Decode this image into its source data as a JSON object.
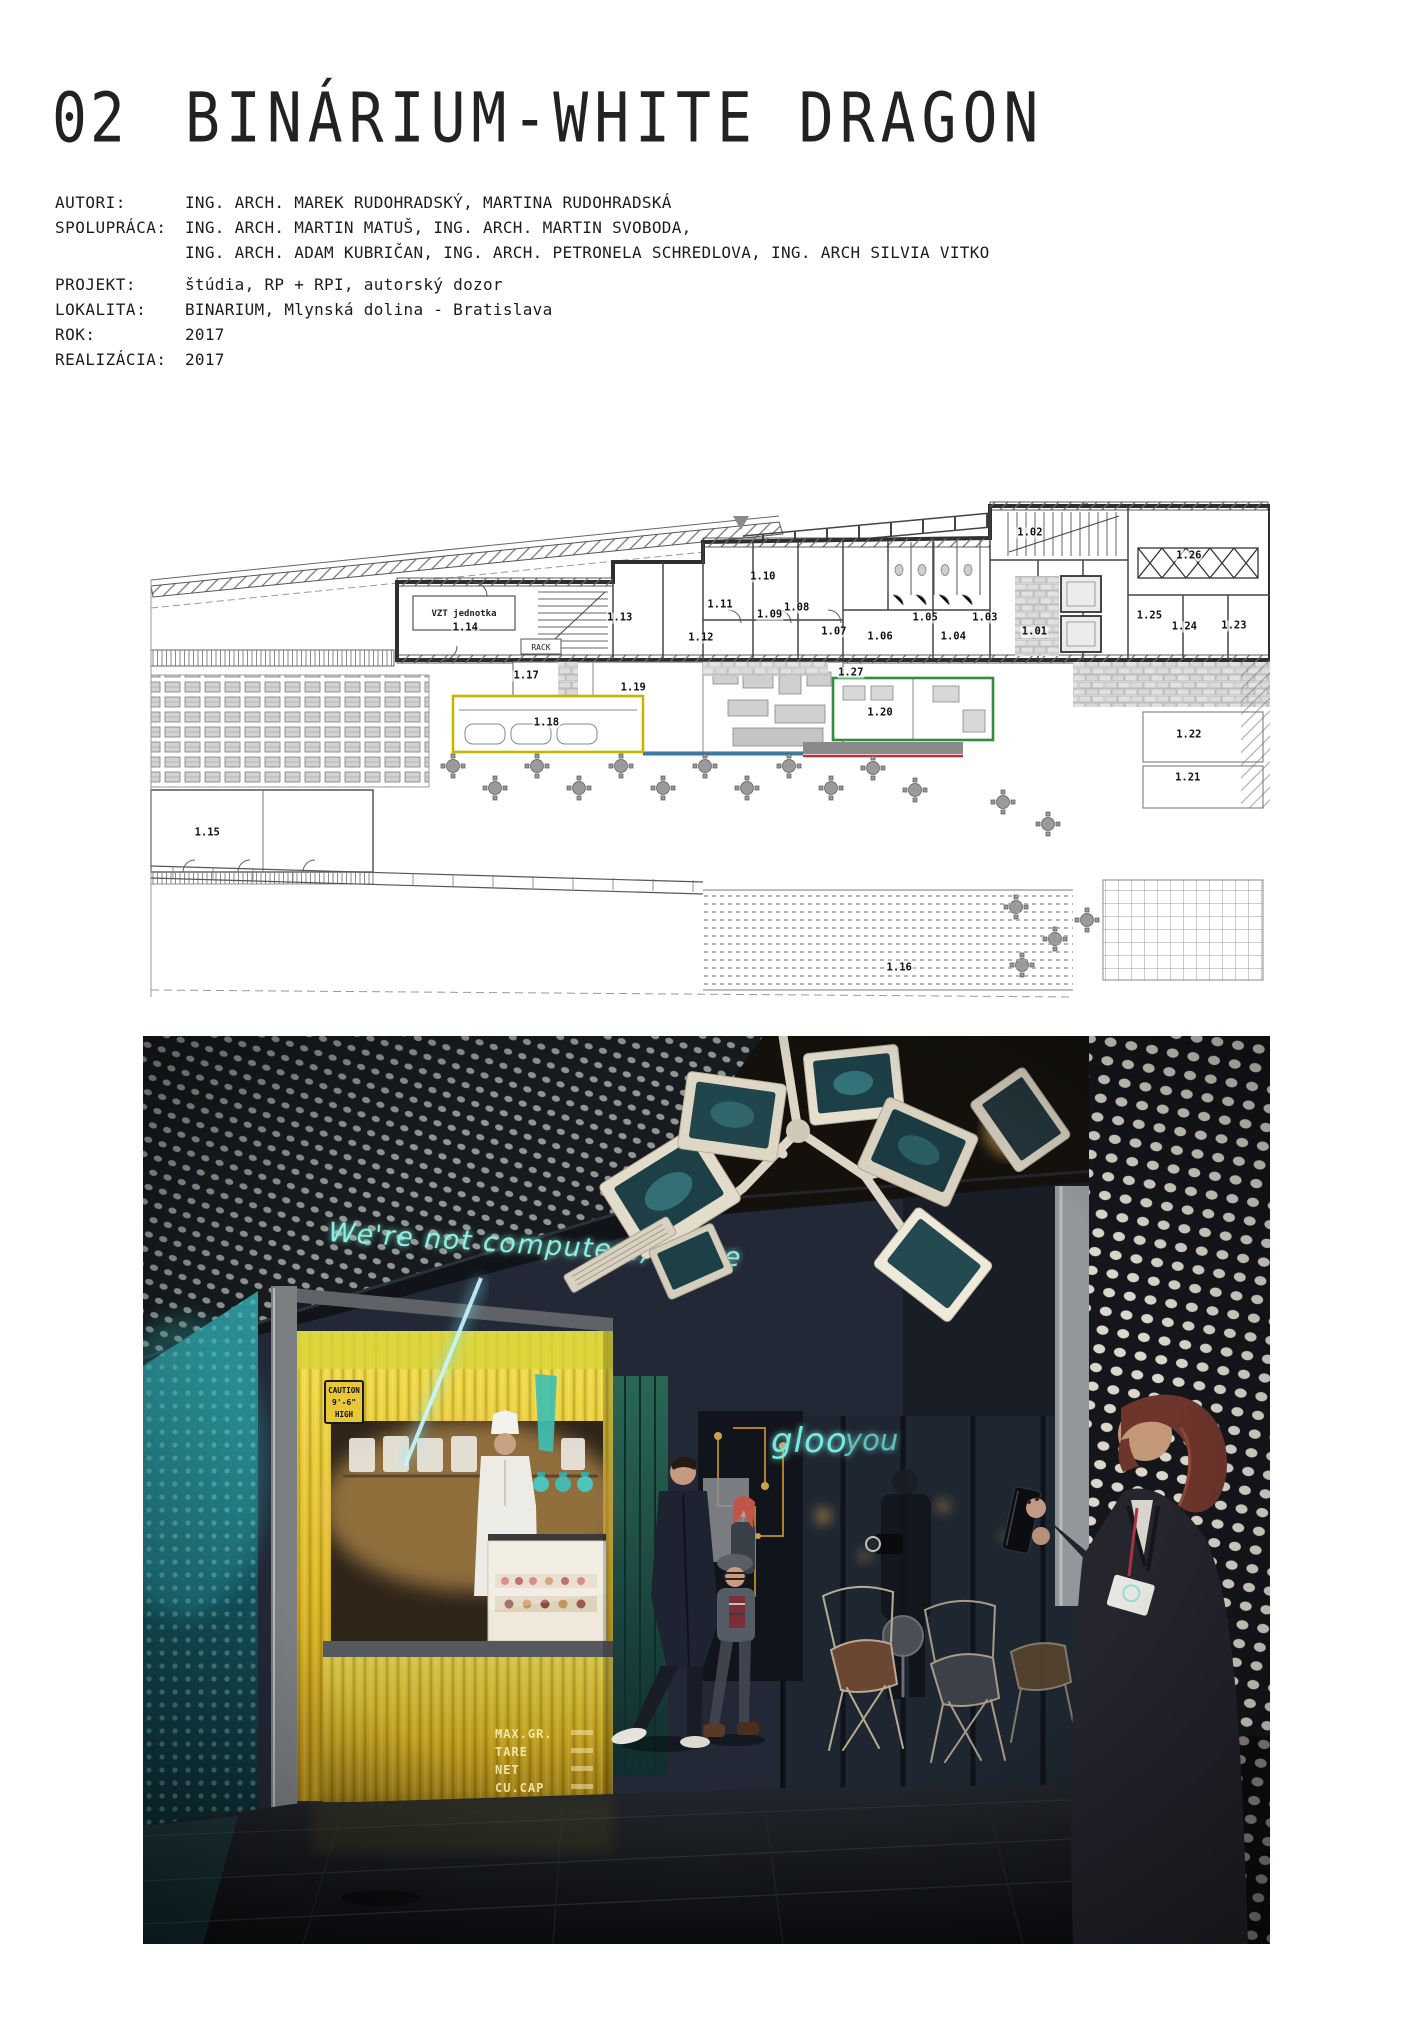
{
  "page": {
    "number": "02",
    "title": "BINÁRIUM-WHITE DRAGON"
  },
  "metadata": {
    "rows": [
      {
        "label": "AUTORI:",
        "value": "ING. ARCH. MAREK RUDOHRADSKÝ, MARTINA RUDOHRADSKÁ"
      },
      {
        "label": "SPOLUPRÁCA:",
        "value": "ING. ARCH. MARTIN MATUŠ, ING. ARCH. MARTIN SVOBODA,"
      },
      {
        "label": "",
        "value": "ING. ARCH. ADAM KUBRIČAN, ING. ARCH. PETRONELA SCHREDLOVA, ING. ARCH SILVIA VITKO"
      },
      {
        "label": "PROJEKT:",
        "value": "štúdia, RP + RPI, autorský dozor"
      },
      {
        "label": "LOKALITA:",
        "value": "BINARIUM, Mlynská dolina - Bratislava"
      },
      {
        "label": "ROK:",
        "value": "2017"
      },
      {
        "label": "REALIZÁCIA:",
        "value": "2017"
      }
    ]
  },
  "floor_plan": {
    "annotations": {
      "vzt_unit": "VZT jednotka",
      "rack": "RACK"
    },
    "accent_colors": {
      "yellow": "#c9b500",
      "green": "#2f8f3a",
      "red": "#c03030",
      "blue": "#2b7bb5"
    },
    "rooms": [
      {
        "label": "1.01",
        "x": 79.1,
        "y": 26.4
      },
      {
        "label": "1.02",
        "x": 78.7,
        "y": 6.6
      },
      {
        "label": "1.03",
        "x": 74.7,
        "y": 23.6
      },
      {
        "label": "1.04",
        "x": 71.9,
        "y": 27.4
      },
      {
        "label": "1.05",
        "x": 69.4,
        "y": 23.6
      },
      {
        "label": "1.06",
        "x": 65.4,
        "y": 27.4
      },
      {
        "label": "1.07",
        "x": 61.3,
        "y": 26.4
      },
      {
        "label": "1.08",
        "x": 58.0,
        "y": 21.6
      },
      {
        "label": "1.09",
        "x": 55.6,
        "y": 23.0
      },
      {
        "label": "1.10",
        "x": 55.0,
        "y": 15.4
      },
      {
        "label": "1.11",
        "x": 51.2,
        "y": 21.0
      },
      {
        "label": "1.12",
        "x": 49.5,
        "y": 27.6
      },
      {
        "label": "1.13",
        "x": 42.3,
        "y": 23.6
      },
      {
        "label": "1.14",
        "x": 28.6,
        "y": 25.6
      },
      {
        "label": "1.15",
        "x": 5.7,
        "y": 66.6
      },
      {
        "label": "1.16",
        "x": 67.1,
        "y": 93.6
      },
      {
        "label": "1.17",
        "x": 34.0,
        "y": 35.2
      },
      {
        "label": "1.18",
        "x": 35.8,
        "y": 44.6
      },
      {
        "label": "1.19",
        "x": 43.5,
        "y": 37.6
      },
      {
        "label": "1.20",
        "x": 65.4,
        "y": 42.6
      },
      {
        "label": "1.21",
        "x": 92.7,
        "y": 55.6
      },
      {
        "label": "1.22",
        "x": 92.8,
        "y": 47.0
      },
      {
        "label": "1.23",
        "x": 96.8,
        "y": 25.2
      },
      {
        "label": "1.24",
        "x": 92.4,
        "y": 25.4
      },
      {
        "label": "1.25",
        "x": 89.3,
        "y": 23.2
      },
      {
        "label": "1.26",
        "x": 92.8,
        "y": 11.2
      },
      {
        "label": "1.27",
        "x": 62.8,
        "y": 34.6
      }
    ]
  },
  "photo": {
    "neon_quote": "We're not computers, we're",
    "neon_sign_left": "gloo",
    "neon_sign_right": "you",
    "caution_sign": {
      "line1": "CAUTION",
      "line2": "9'-6\"",
      "line3": "HIGH"
    },
    "container_marks": [
      "MAX.GR.",
      "TARE",
      "NET",
      "CU.CAP"
    ],
    "colors": {
      "neon_teal": "#7deedd",
      "kiosk_yellow": "#e5bf25",
      "glow_teal": "#1e7a84"
    }
  }
}
